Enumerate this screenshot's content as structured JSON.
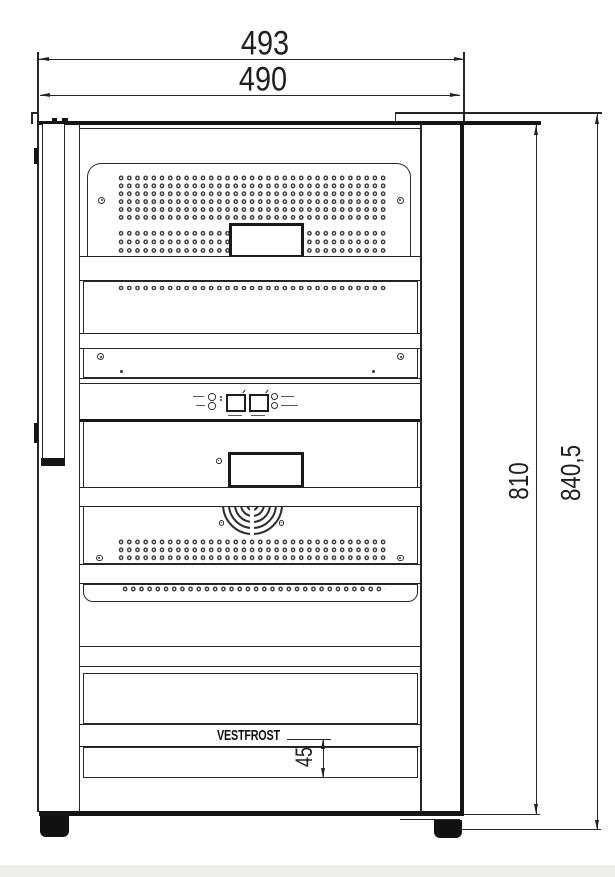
{
  "drawing": {
    "brand_label": "VESTFROST",
    "dimensions": {
      "overall_width": "493",
      "body_width": "490",
      "body_height": "810",
      "total_height": "840,5",
      "base_grille_height": "45"
    }
  }
}
